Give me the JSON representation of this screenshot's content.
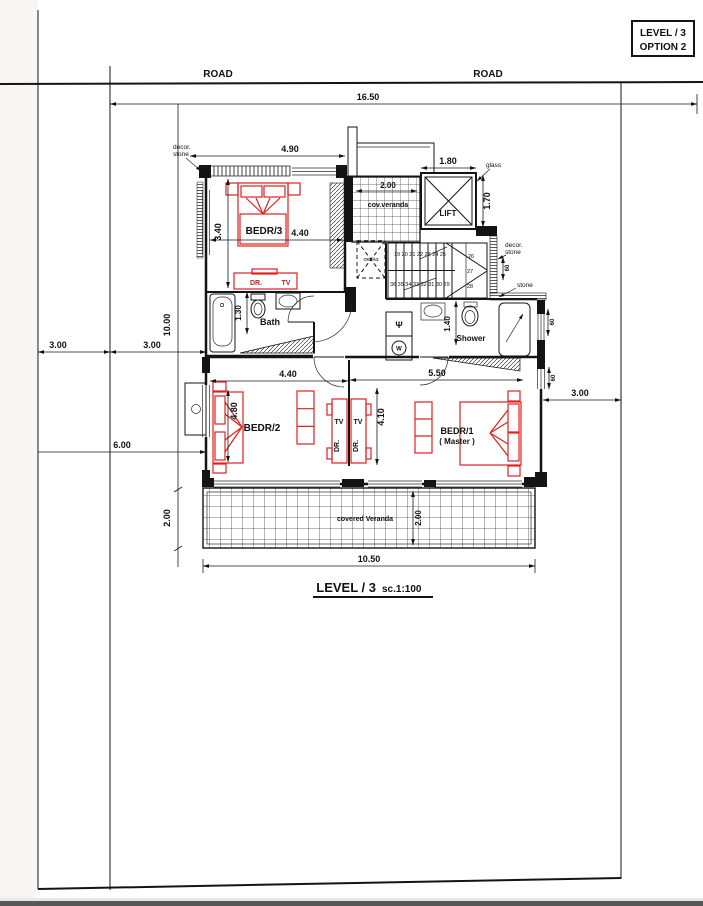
{
  "sheet": {
    "level_box": {
      "line1": "LEVEL / 3",
      "line2": "OPTION 2"
    },
    "title": {
      "main": "LEVEL / 3",
      "scale": "sc.1:100"
    }
  },
  "site": {
    "road_left": "ROAD",
    "road_right": "ROAD",
    "dim_total_width": "16.50",
    "dim_left_a": "3.00",
    "dim_left_b": "3.00",
    "dim_depth": "10.00",
    "dim_rear": "6.00",
    "dim_veranda_left": "2.00",
    "dim_right": "3.00"
  },
  "plan": {
    "bedr3": {
      "label": "BEDR/3",
      "dim_top": "4.90",
      "dim_width": "4.40",
      "dim_depth": "3.40",
      "dr": "DR.",
      "tv": "TV"
    },
    "cov_veranda": {
      "label": "cov.veranda",
      "dim": "2.00"
    },
    "lift": {
      "label": "LIFT",
      "dim_width": "1.80",
      "dim_depth": "1.70",
      "glass": "glass"
    },
    "stairs": {
      "label": "σκάλα",
      "row_top": "19 20 21 22 23 24 25",
      "n26": "26",
      "n27": "27",
      "n28": "28",
      "row_bottom": "36 35 34 33 32 31 30 29"
    },
    "bath": {
      "label": "Bath",
      "dim": "1.30"
    },
    "closet": {
      "psi": "Ψ",
      "w": "W"
    },
    "shower": {
      "label": "Shower",
      "dim": "1.40"
    },
    "bedr2": {
      "label": "BEDR/2",
      "dim_width": "4.40",
      "dim_bed": "4.80",
      "tv_left": "TV",
      "tv_right": "TV",
      "dr_left": "DR.",
      "dr_right": "DR."
    },
    "bedr1": {
      "label": "BEDR/1",
      "sublabel": "( Master )",
      "dim_width": "5.50",
      "dim_depth": "4.10"
    },
    "veranda": {
      "label": "covered Veranda",
      "dim_depth": "2.00",
      "dim_width": "10.50"
    },
    "notes": {
      "decor_tl_1": "decor.",
      "decor_tl_2": "stone",
      "decor_tr_1": "decor.",
      "decor_tr_2": "stone",
      "stone": "stone",
      "d60_a": "60",
      "d60_b": "60",
      "d60_c": "60"
    }
  },
  "colors": {
    "line": "#141414",
    "furniture_red": "#e02020",
    "paper": "#ffffff"
  }
}
